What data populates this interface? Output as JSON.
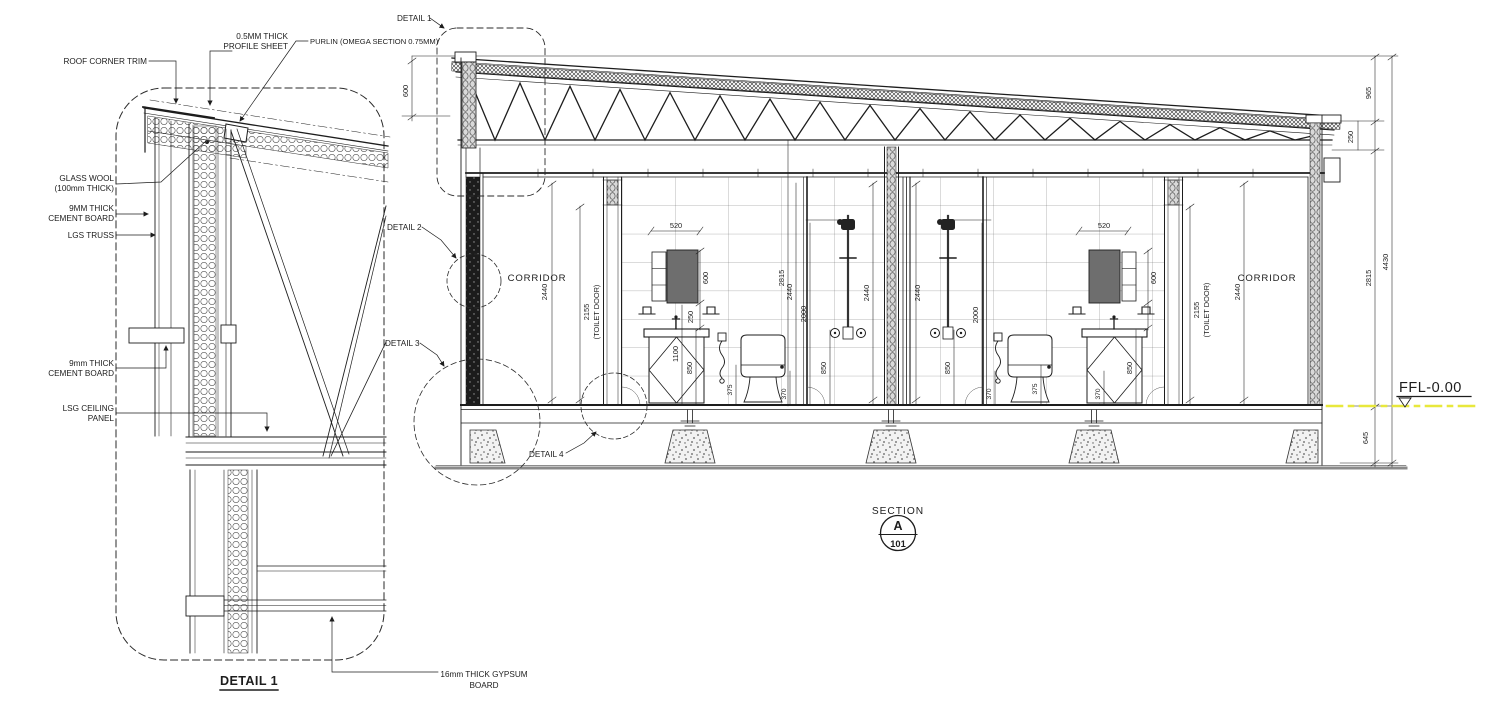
{
  "detail_view": {
    "title": "DETAIL 1",
    "labels": {
      "roof_corner_trim": "ROOF CORNER TRIM",
      "profile_sheet_1": "0.5MM THICK",
      "profile_sheet_2": "PROFILE SHEET",
      "purlin": "PURLIN (OMEGA SECTION 0.75MM)",
      "glass_wool_1": "GLASS WOOL",
      "glass_wool_2": "(100mm THICK)",
      "cement_board_upper_1": "9MM THICK",
      "cement_board_upper_2": "CEMENT BOARD",
      "lgs_truss": "LGS TRUSS",
      "cement_board_lower_1": "9mm THICK",
      "cement_board_lower_2": "CEMENT BOARD",
      "lsg_ceiling_1": "LSG CEILING",
      "lsg_ceiling_2": "PANEL",
      "gypsum_1": "16mm THICK GYPSUM",
      "gypsum_2": "BOARD"
    }
  },
  "section_view": {
    "callouts": {
      "d1": "DETAIL 1",
      "d2": "DETAIL 2",
      "d3": "DETAIL 3",
      "d4": "DETAIL 4"
    },
    "rooms": {
      "corridor_left": "CORRIDOR",
      "corridor_right": "CORRIDOR"
    },
    "level_label": "FFL-0.00",
    "title_block": {
      "label": "SECTION",
      "letter": "A",
      "sheet": "101"
    },
    "dims": {
      "roof_depth": "600",
      "corridor_left": "2440",
      "door_left": "2155",
      "door_left_note": "(TOILET DOOR)",
      "mirror_w_left": "520",
      "mirror_h_left": "600",
      "mirror_gap_left": "250",
      "vanity_h_left": "850",
      "spray_h_left": "1100",
      "wc_off_left": "375",
      "wall_h_left": "2815",
      "bay_left": "2440",
      "shower_h_left": "2000",
      "curb_left": "370",
      "valve_left": "850",
      "stall_left": "2440",
      "stall_right": "2440",
      "shower_h_right": "2000",
      "valve_right": "850",
      "curb_right": "370",
      "wc_off_right": "375",
      "curb_right2": "370",
      "vanity_h_right": "850",
      "mirror_h_right": "600",
      "mirror_w_right": "520",
      "door_right": "2155",
      "door_right_note": "(TOILET DOOR)",
      "corridor_right": "2440",
      "wall_h_right": "2815",
      "total_h": "4430",
      "roof_right": "965",
      "eave_right": "250",
      "plinth": "645"
    }
  },
  "colors": {
    "line": "#1d1d1d",
    "cabinet": "#6e6e6e",
    "level_line": "#e8e83c",
    "ground": "#8a8a8a"
  }
}
